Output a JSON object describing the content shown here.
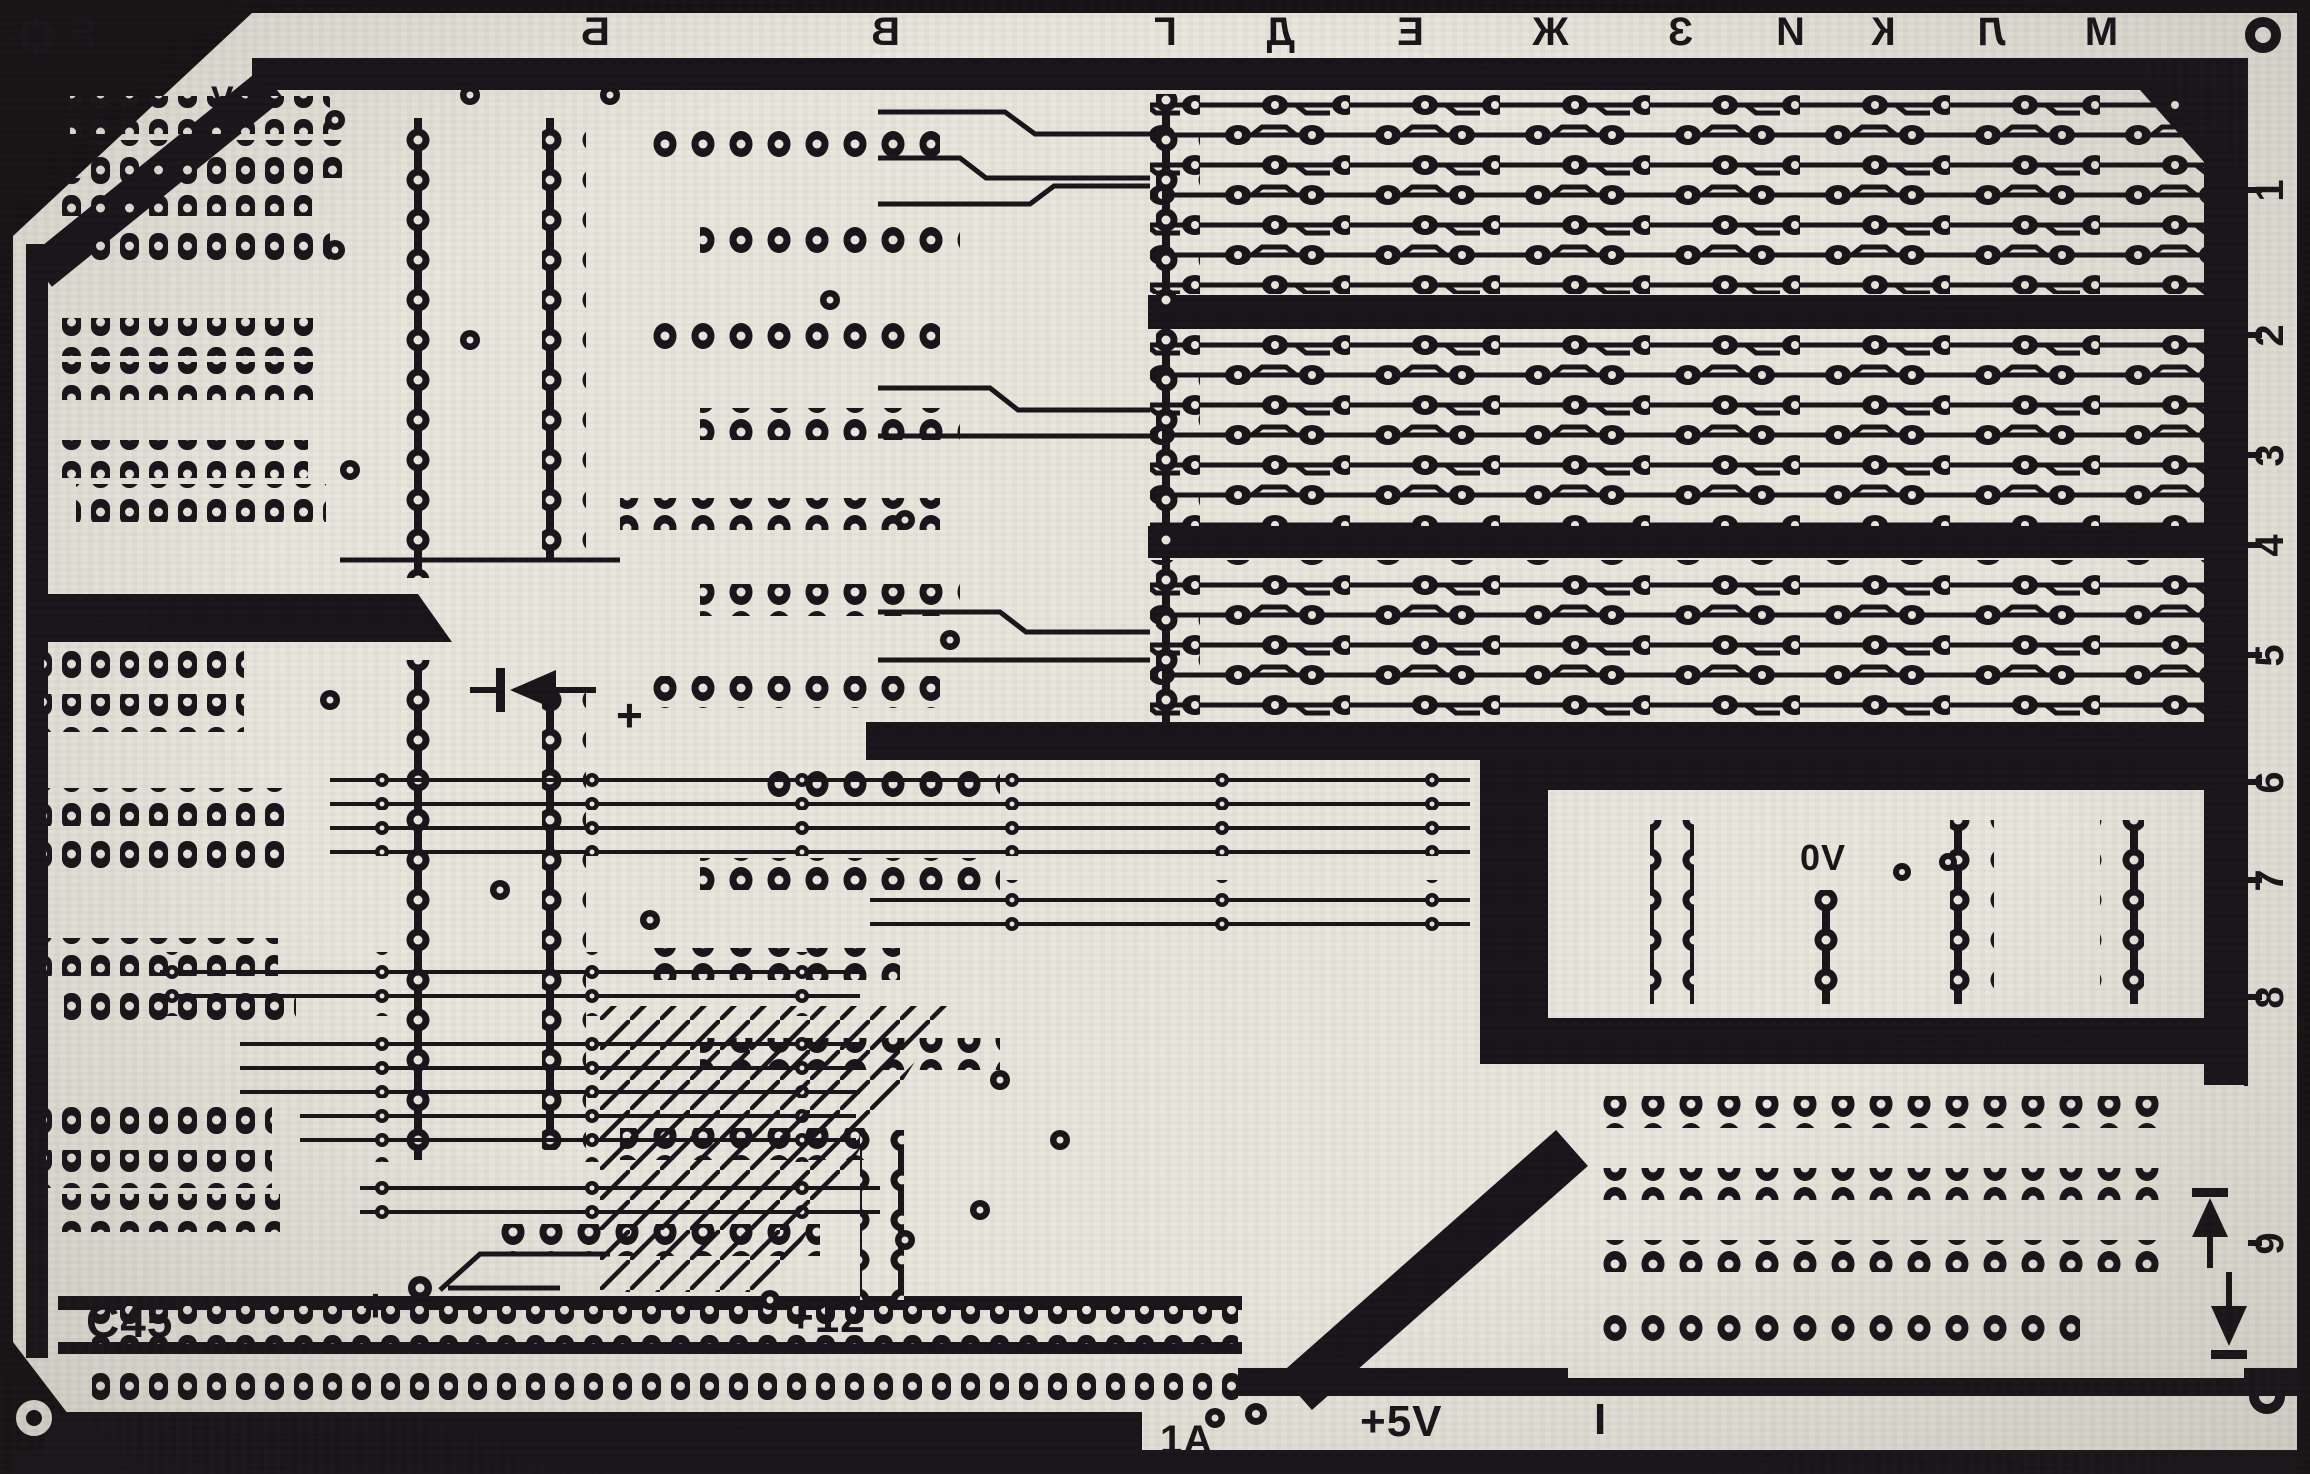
{
  "colors": {
    "ink": "#17151a",
    "paper": "#e9e6dd",
    "paper_shadow": "#d8d4c8"
  },
  "edge": {
    "corner_letter": "Я",
    "top_letters": [
      "Б",
      "В",
      "Г",
      "Д",
      "Е",
      "Ж",
      "З",
      "И",
      "К",
      "Л",
      "М"
    ],
    "right_numbers": [
      "1",
      "2",
      "3",
      "4",
      "5",
      "6",
      "7",
      "8",
      "9"
    ]
  },
  "labels": {
    "ov_top": "0V",
    "ov_mid": "0V",
    "c45": "C45",
    "plus_near_c45": "+",
    "plus_12": "+12",
    "plus_near_diode": "+",
    "amp_rating": "1A",
    "plus_5v": "+5V",
    "index_bar": "I"
  },
  "icons": {
    "diode_left": "left-pointing diode symbol",
    "diode_up": "up-pointing diode symbol",
    "diode_down": "down-pointing diode symbol",
    "corner_pad": "round tooling pad"
  }
}
